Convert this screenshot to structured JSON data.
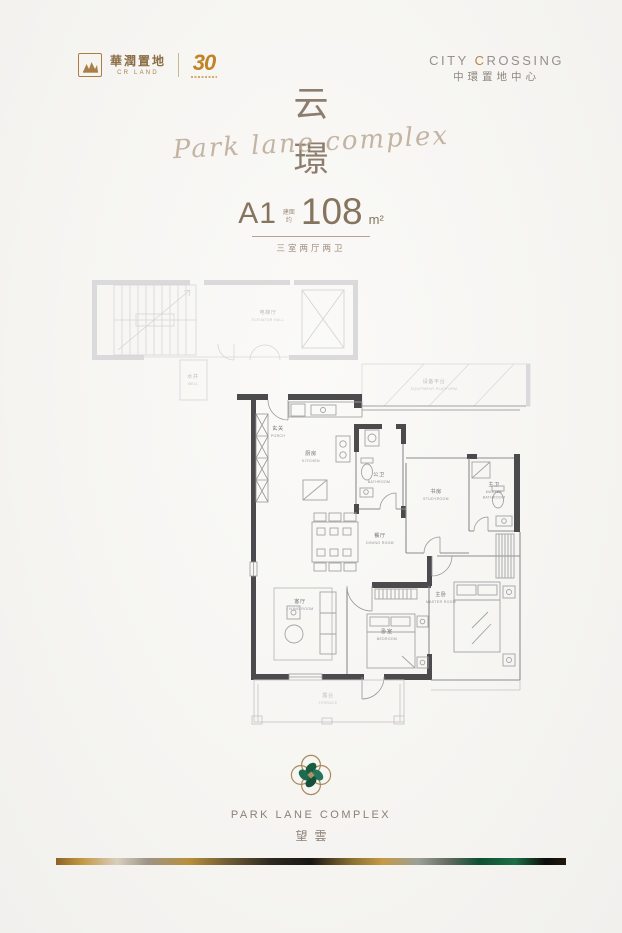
{
  "header": {
    "logo": {
      "zh": "華潤置地",
      "en": "CR LAND",
      "anniversary": "30"
    },
    "project": {
      "en_part1": "CITY ",
      "en_c": "C",
      "en_rest": "ROSSING",
      "zh": "中環置地中心"
    }
  },
  "title": {
    "top": "云",
    "bottom": "璟",
    "script": "Park lane complex"
  },
  "unit": {
    "code": "A1",
    "prefix1": "建面",
    "prefix2": "约",
    "area": "108",
    "unit": "m²",
    "subtitle": "三室两厅两卫"
  },
  "plan": {
    "rooms": [
      {
        "zh": "电梯厅",
        "en": "ELEVATOR HALL"
      },
      {
        "zh": "水井",
        "en": "WELL"
      },
      {
        "zh": "设备平台",
        "en": "EQUIPMENT PLATFORM"
      },
      {
        "zh": "玄关",
        "en": "PORCH"
      },
      {
        "zh": "厨房",
        "en": "KITCHEN"
      },
      {
        "zh": "公卫",
        "en": "BATHROOM"
      },
      {
        "zh": "书房",
        "en": "STUDYROOM"
      },
      {
        "zh": "主卫",
        "en": "MASTER",
        "en2": "BATHROOM"
      },
      {
        "zh": "餐厅",
        "en": "DINING ROOM"
      },
      {
        "zh": "客厅",
        "en": "LIVING ROOM"
      },
      {
        "zh": "卧室",
        "en": "BEDROOM"
      },
      {
        "zh": "主卧",
        "en": "MASTER ROOM"
      },
      {
        "zh": "露台",
        "en": "TERRACE"
      }
    ]
  },
  "footer": {
    "brand_en": "PARK LANE COMPLEX",
    "brand_zh": "望雲"
  },
  "colors": {
    "accent_gold": "#b9862f",
    "bronze_outline": "#a8895a",
    "malachite_green": "#176345",
    "wall_dark": "#4b4b4d",
    "title_brown": "#8a7a6b"
  }
}
